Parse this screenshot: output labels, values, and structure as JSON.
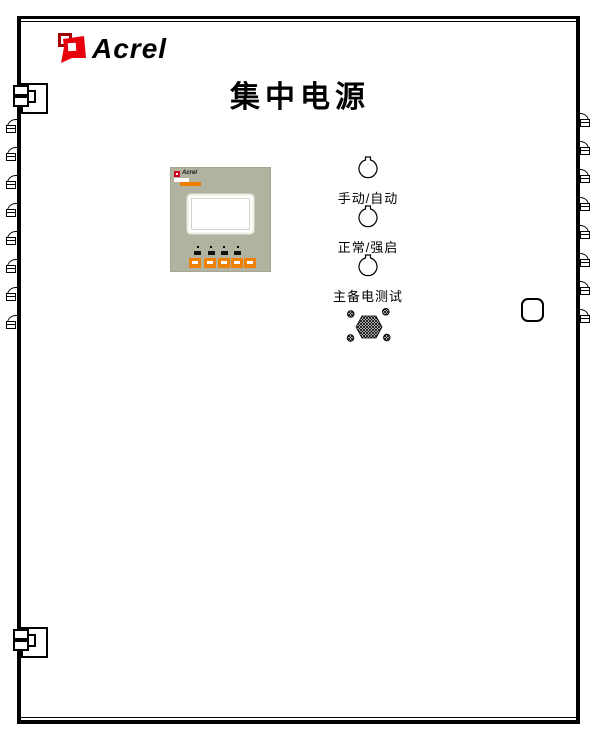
{
  "brand": {
    "logo_text": "Acrel"
  },
  "title": "集中电源",
  "display_panel": {
    "mini_logo_text": "Acrel",
    "button_count": 5,
    "indicator_count": 4
  },
  "switches": [
    {
      "name": "manual-auto",
      "label": "手动/自动"
    },
    {
      "name": "normal-force-start",
      "label": "正常/强启"
    },
    {
      "name": "main-backup-power-test",
      "label": "主备电测试"
    }
  ],
  "colors": {
    "button_orange": "#F08000",
    "logo_red": "#E8000B",
    "logo_dark_red": "#A00000",
    "panel_background": "#B2B2A1"
  }
}
